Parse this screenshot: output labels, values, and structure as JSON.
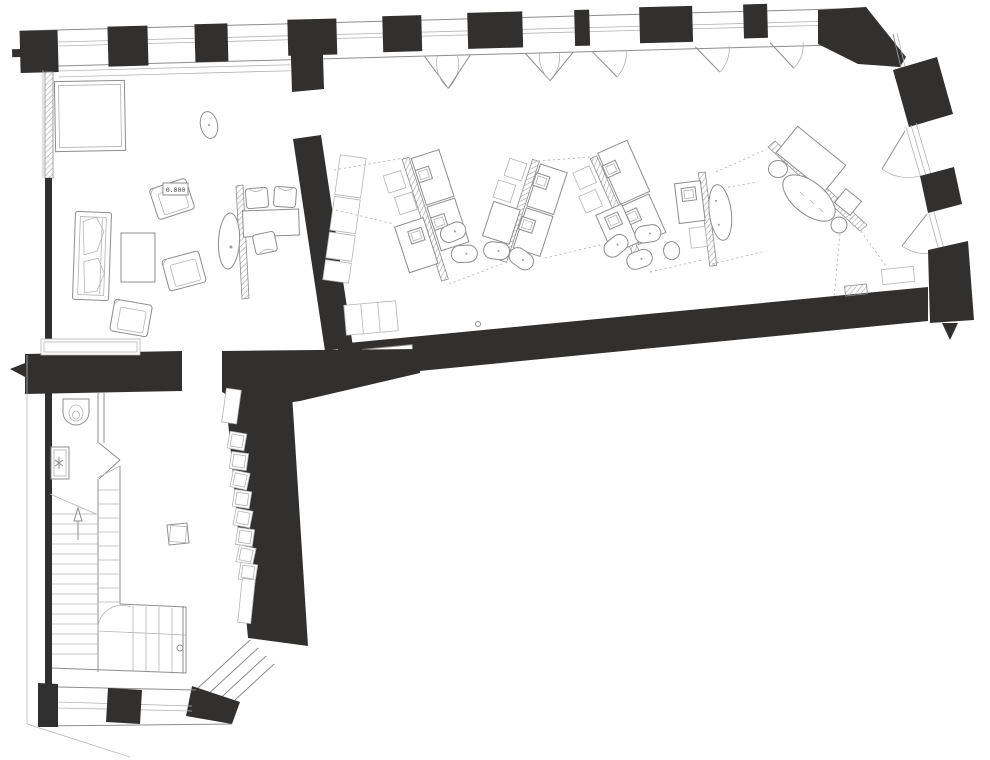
{
  "plan": {
    "elevation_label": "0.000",
    "colors": {
      "wall": "#31302e",
      "line": "#8d8d8d",
      "line_light": "#b4b4b4",
      "hatch": "#9f9f9f",
      "bg": "#ffffff"
    }
  }
}
